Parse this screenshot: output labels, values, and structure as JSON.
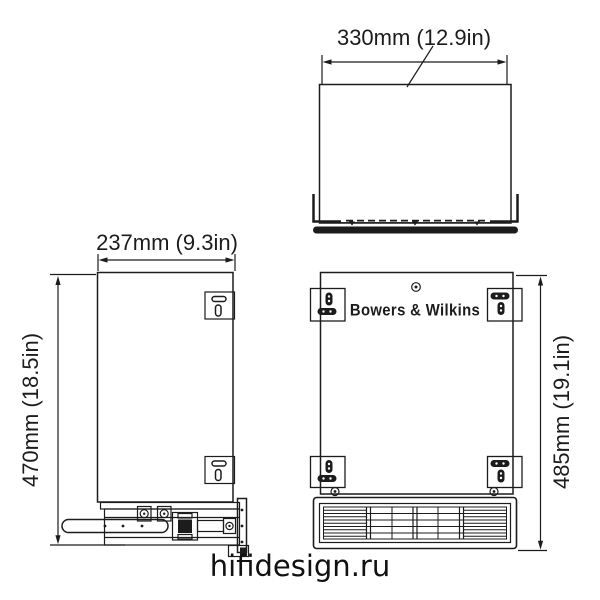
{
  "top_view": {
    "width_label": "330mm (12.9in)"
  },
  "side_view": {
    "depth_label": "237mm (9.3in)",
    "height_label": "470mm (18.5in)"
  },
  "front_view": {
    "height_label": "485mm (19.1in)",
    "brand_label": "Bowers & Wilkins"
  },
  "watermark": {
    "text": "hifidesign.ru"
  },
  "colors": {
    "line": "#1c1c1c",
    "background": "#ffffff"
  }
}
